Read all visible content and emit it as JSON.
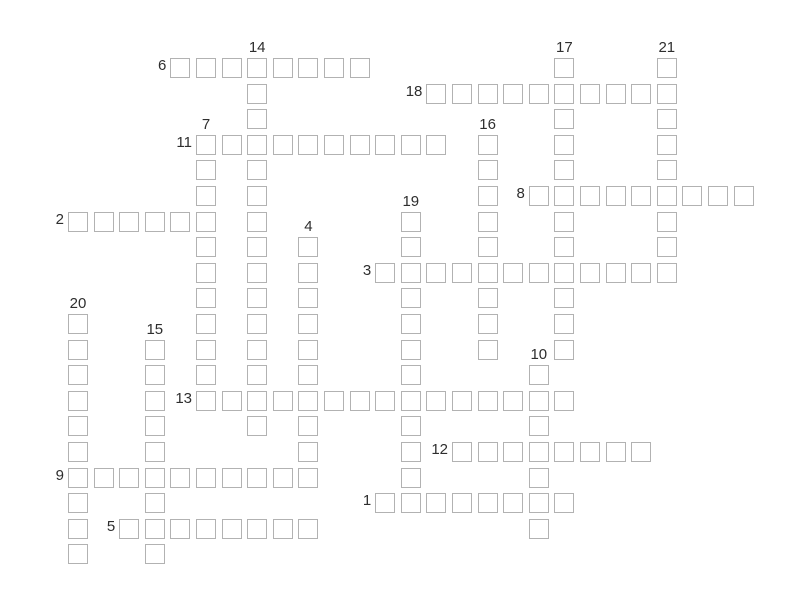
{
  "app": {
    "kind": "crossword-puzzle",
    "background_color": "#ffffff"
  },
  "grid": {
    "origin_x": 68,
    "origin_y": 58,
    "pitch": 25.6,
    "cell_size": 20,
    "columns": 27,
    "rows": 20,
    "cell_border_color": "#b2b2b2",
    "cell_fill_color": "#ffffff",
    "number_color": "#2e2e2e",
    "number_font_size": 15
  },
  "entries": [
    {
      "number": 1,
      "direction": "across",
      "row": 17,
      "col": 12,
      "length": 8
    },
    {
      "number": 2,
      "direction": "across",
      "row": 6,
      "col": 0,
      "length": 6
    },
    {
      "number": 3,
      "direction": "across",
      "row": 8,
      "col": 12,
      "length": 12
    },
    {
      "number": 4,
      "direction": "down",
      "row": 7,
      "col": 9,
      "length": 10
    },
    {
      "number": 5,
      "direction": "across",
      "row": 18,
      "col": 2,
      "length": 8
    },
    {
      "number": 6,
      "direction": "across",
      "row": 0,
      "col": 4,
      "length": 8
    },
    {
      "number": 7,
      "direction": "down",
      "row": 3,
      "col": 5,
      "length": 11
    },
    {
      "number": 8,
      "direction": "across",
      "row": 5,
      "col": 18,
      "length": 9
    },
    {
      "number": 9,
      "direction": "across",
      "row": 16,
      "col": 0,
      "length": 10
    },
    {
      "number": 10,
      "direction": "down",
      "row": 12,
      "col": 18,
      "length": 7
    },
    {
      "number": 11,
      "direction": "across",
      "row": 3,
      "col": 5,
      "length": 10
    },
    {
      "number": 12,
      "direction": "across",
      "row": 15,
      "col": 15,
      "length": 8
    },
    {
      "number": 13,
      "direction": "across",
      "row": 13,
      "col": 5,
      "length": 15
    },
    {
      "number": 14,
      "direction": "down",
      "row": 0,
      "col": 7,
      "length": 15
    },
    {
      "number": 15,
      "direction": "down",
      "row": 11,
      "col": 3,
      "length": 9
    },
    {
      "number": 16,
      "direction": "down",
      "row": 3,
      "col": 16,
      "length": 9
    },
    {
      "number": 17,
      "direction": "down",
      "row": 0,
      "col": 19,
      "length": 12
    },
    {
      "number": 18,
      "direction": "across",
      "row": 1,
      "col": 14,
      "length": 10
    },
    {
      "number": 19,
      "direction": "down",
      "row": 6,
      "col": 13,
      "length": 12
    },
    {
      "number": 20,
      "direction": "down",
      "row": 10,
      "col": 0,
      "length": 10
    },
    {
      "number": 21,
      "direction": "down",
      "row": 0,
      "col": 23,
      "length": 9
    }
  ]
}
